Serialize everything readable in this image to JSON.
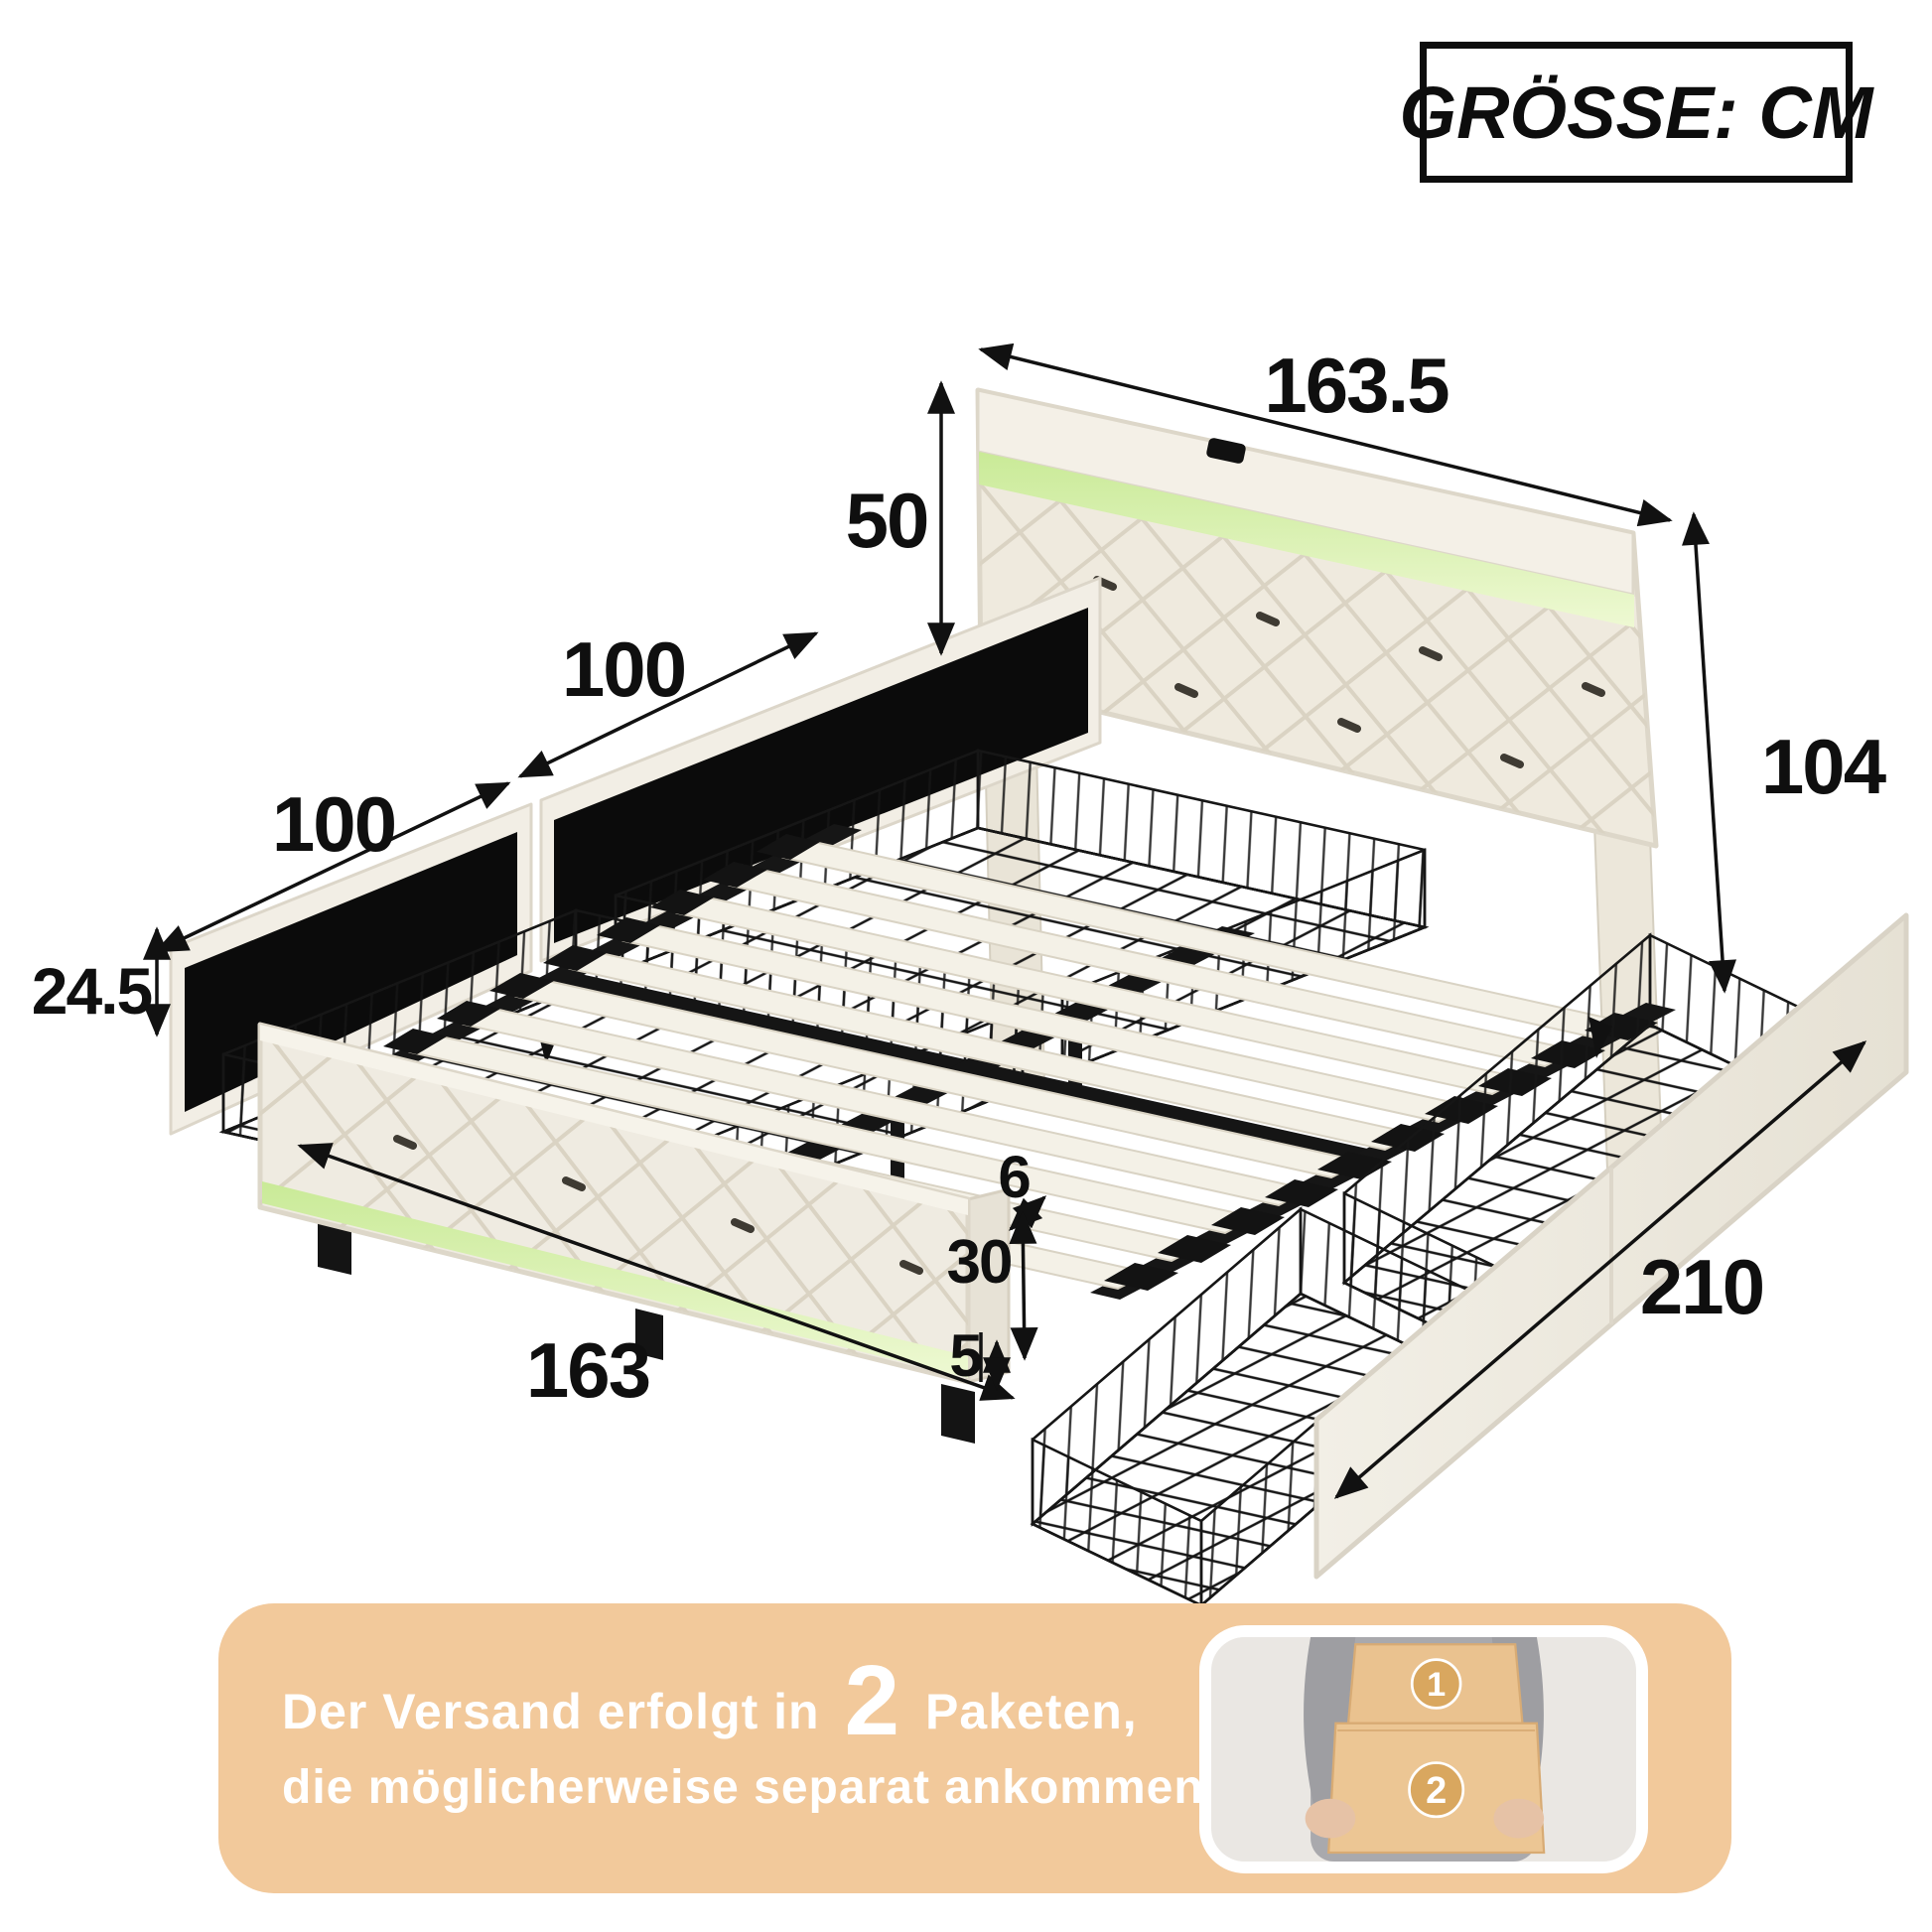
{
  "header": {
    "size_label": "GRÖSSE: CM"
  },
  "dimensions": {
    "unit_note": "CM",
    "headboard_width": "163.5",
    "headboard_height": "50",
    "overall_height": "104",
    "drawer_rear_width": "100",
    "drawer_front_width": "100",
    "drawer_height": "24.5",
    "footboard_width": "163",
    "frame_gap": "6",
    "footboard_height": "30",
    "leg_height": "5",
    "bed_length": "210"
  },
  "banner": {
    "line1_prefix": "Der Versand erfolgt in",
    "packages_count": "2",
    "line1_suffix": "Paketen,",
    "line2": "die möglicherweise separat ankommen",
    "box1_label": "1",
    "box2_label": "2"
  },
  "colors": {
    "banner_bg": "#f2c99b",
    "led_strip": "#d9f2a9",
    "upholstery": "#f0ece2",
    "metal_frame": "#151515",
    "box_tan": "#eac28f",
    "badge_tan": "#d9a75f"
  }
}
